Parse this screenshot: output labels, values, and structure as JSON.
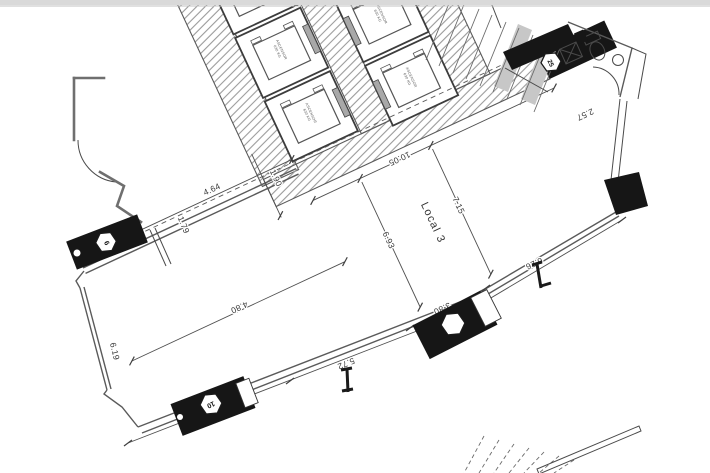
{
  "plan": {
    "room_label": "Local 3",
    "dimensions": {
      "top_left_wall": "4.64",
      "door_offset": "1.79",
      "shaft_width": "1.90",
      "top_wall": "10.05",
      "depth_right": "7.15",
      "depth_left": "6.93",
      "bottom_right_wall": "6.26",
      "interior_left": "4.80",
      "left_wall": "6.19",
      "bottom_segment_1": "4.18",
      "bottom_segment_2": "5.72",
      "bottom_column": "3.80",
      "wc_width": "2.57"
    },
    "columns": {
      "c6": "6",
      "c10": "10",
      "c25": "25",
      "c_unnumbered": ""
    },
    "elevator": {
      "label_line1": "ASCENSOR",
      "label_line2": "630 KG"
    },
    "colors": {
      "ink": "#4a4a4a",
      "wall_black": "#161616",
      "hatch": "#9a9a9a",
      "door_gray": "#a8a8a8",
      "topbar": "#d9d9d9",
      "paper": "#ffffff"
    }
  }
}
